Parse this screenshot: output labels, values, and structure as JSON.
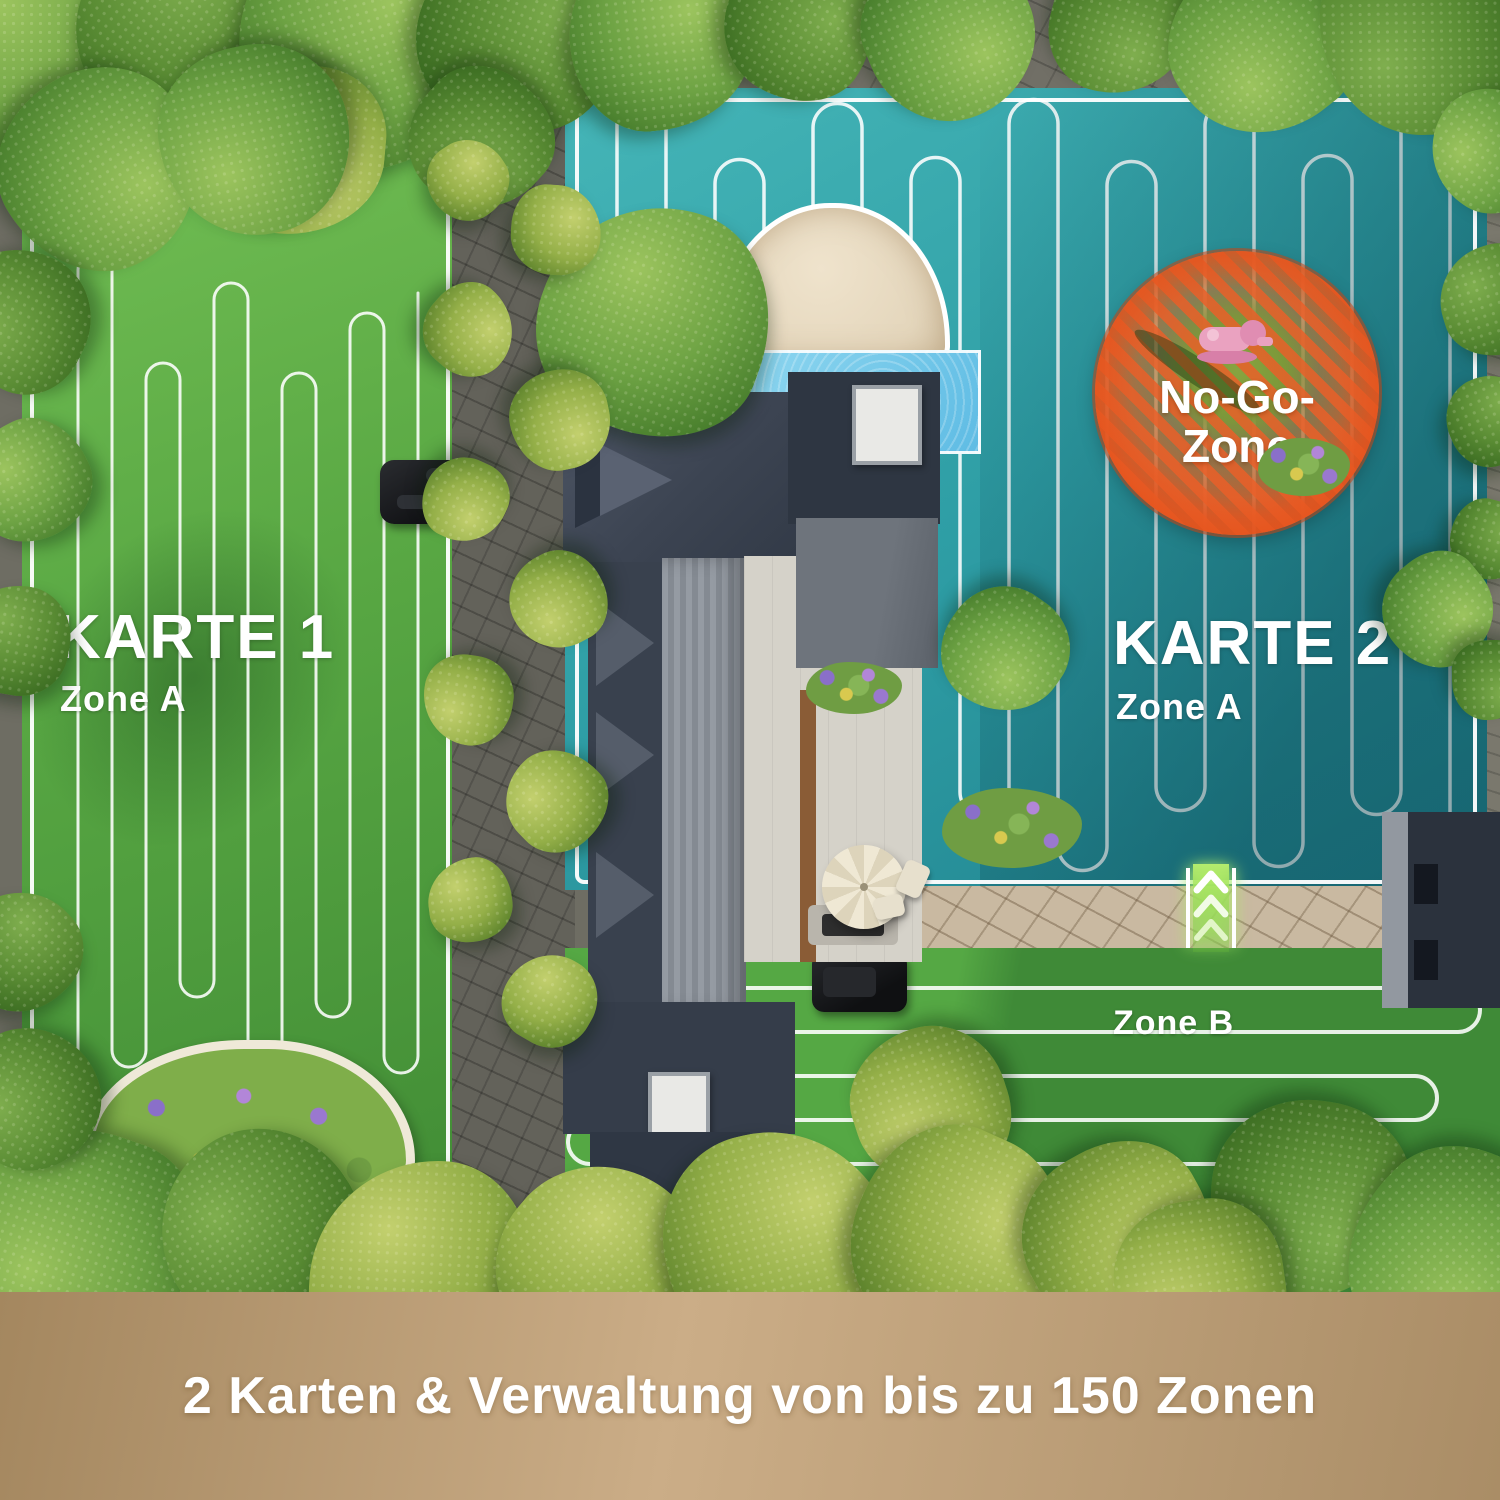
{
  "maps": {
    "map1": {
      "title": "KARTE 1",
      "zone_label": "Zone A"
    },
    "map2": {
      "title": "KARTE 2",
      "zone_label": "Zone A",
      "zone_b_label": "Zone B"
    }
  },
  "no_go_zone": {
    "label_line1": "No-Go-",
    "label_line2": "Zone"
  },
  "caption": "2 Karten & Verwaltung von bis zu 150 Zonen",
  "colors": {
    "grass_green": "#58a743",
    "grass_light": "#74c055",
    "grass_dark": "#3f8a34",
    "grassb_light": "#55a844",
    "grassb_dark": "#3f8a37",
    "zone_teal": "#2f9fa6",
    "teal_light": "#45b5b7",
    "no_go_orange": "#e8551d",
    "pool_blue": "#7ccdec",
    "stone_path": "#c9b9a1",
    "caption_band_tan": "#bb9c74",
    "arrow_green": "#8adf3e",
    "text_white": "#ffffff"
  }
}
